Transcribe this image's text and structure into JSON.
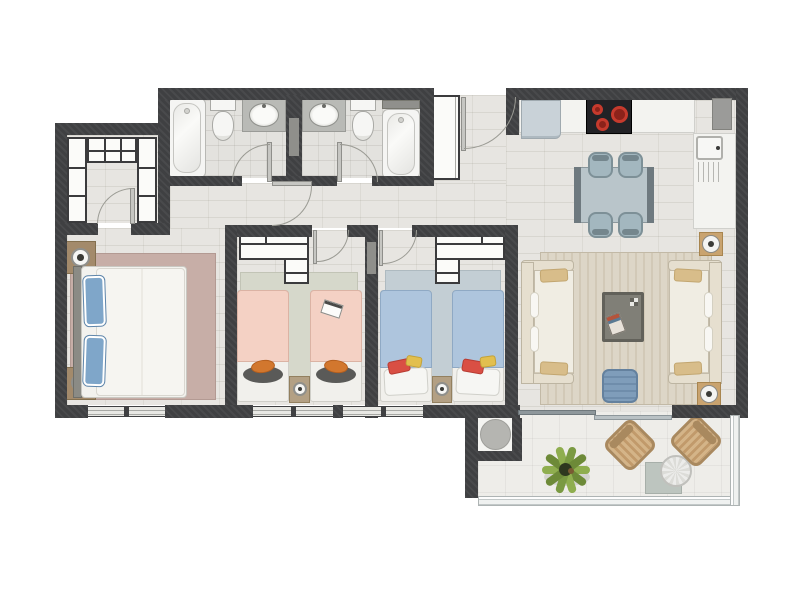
{
  "title": "apartment-floor-plan",
  "colors": {
    "wall": "#3f4042",
    "floor": "#e7e5e1",
    "bath_floor": "#e3e2de",
    "terrace_floor": "#eeede9",
    "rug_master": "#c7aea7",
    "rug_bed2": "#d6d8cb",
    "rug_bed3": "#c3ced4",
    "rug_living_a": "#ddd6c7",
    "rug_living_b": "#d2c9b7",
    "bed_white": "#f3f2ee",
    "pillow_blue": "#7fa6c9",
    "blanket_pink": "#f4d1c4",
    "blanket_blue": "#aec5dd",
    "cushion_orange": "#d2772e",
    "cushion_red": "#d94f44",
    "cushion_yellow": "#e2bf4e",
    "cushion_tan": "#d8bd8a",
    "sofa": "#f0ede3",
    "sofa_frame": "#e6dfcf",
    "table_glass": "#b9c5ca",
    "chair": "#a3b7bf",
    "cooktop": "#222226",
    "burner": "#c63a2d",
    "sink_kitchen": "#c9d2d8",
    "counter": "#f3f3f0",
    "coffee_table": "#807f77",
    "pouf": "#7f9dba",
    "pot_base": "#c9a36f",
    "nightstand": "#a38a6b",
    "wicker": "#c8a679",
    "plant_green": "#8fae4f",
    "fixture_white": "#f5f5f3",
    "vanity_counter": "#b9bab6"
  },
  "floor_plan": {
    "type": "apartment-floor-plan",
    "rooms": [
      {
        "name": "entry-nook",
        "furniture": [
          "entry-door",
          "hall-cabinet"
        ]
      },
      {
        "name": "walk-in-closet",
        "furniture": [
          "closet-shelves-left",
          "closet-shelves-top",
          "closet-shelves-right",
          "closet-door"
        ]
      },
      {
        "name": "bathroom-1",
        "furniture": [
          "bathtub",
          "toilet",
          "vanity-sink",
          "door"
        ]
      },
      {
        "name": "bathroom-2",
        "furniture": [
          "vanity-sink",
          "toilet",
          "bathtub",
          "wall-shelf",
          "door"
        ]
      },
      {
        "name": "hallway",
        "furniture": [
          "hall-door"
        ]
      },
      {
        "name": "kitchen",
        "furniture": [
          "kitchen-sink",
          "cooktop",
          "counter",
          "refrigerator",
          "duct"
        ]
      },
      {
        "name": "dining-area",
        "furniture": [
          "dining-table",
          "dining-chair",
          "dining-chair",
          "dining-chair",
          "dining-chair"
        ]
      },
      {
        "name": "living-room",
        "furniture": [
          "sofa-left",
          "sofa-right",
          "coffee-table",
          "pouf",
          "plant-pot",
          "plant-pot",
          "area-rug",
          "sliding-door"
        ]
      },
      {
        "name": "master-bedroom",
        "furniture": [
          "double-bed",
          "nightstand",
          "nightstand",
          "lamp",
          "lamp",
          "rug",
          "window"
        ]
      },
      {
        "name": "bedroom-2",
        "furniture": [
          "single-bed",
          "single-bed",
          "wardrobe",
          "nightstand",
          "foot-cushion",
          "foot-cushion",
          "magazine",
          "rug",
          "window"
        ]
      },
      {
        "name": "bedroom-3",
        "furniture": [
          "single-bed",
          "single-bed",
          "wardrobe",
          "nightstand",
          "rug",
          "window"
        ]
      },
      {
        "name": "terrace",
        "furniture": [
          "wicker-chair",
          "wicker-chair",
          "round-table",
          "table-mat",
          "plant",
          "glass-railing",
          "utility-circle"
        ]
      }
    ]
  }
}
